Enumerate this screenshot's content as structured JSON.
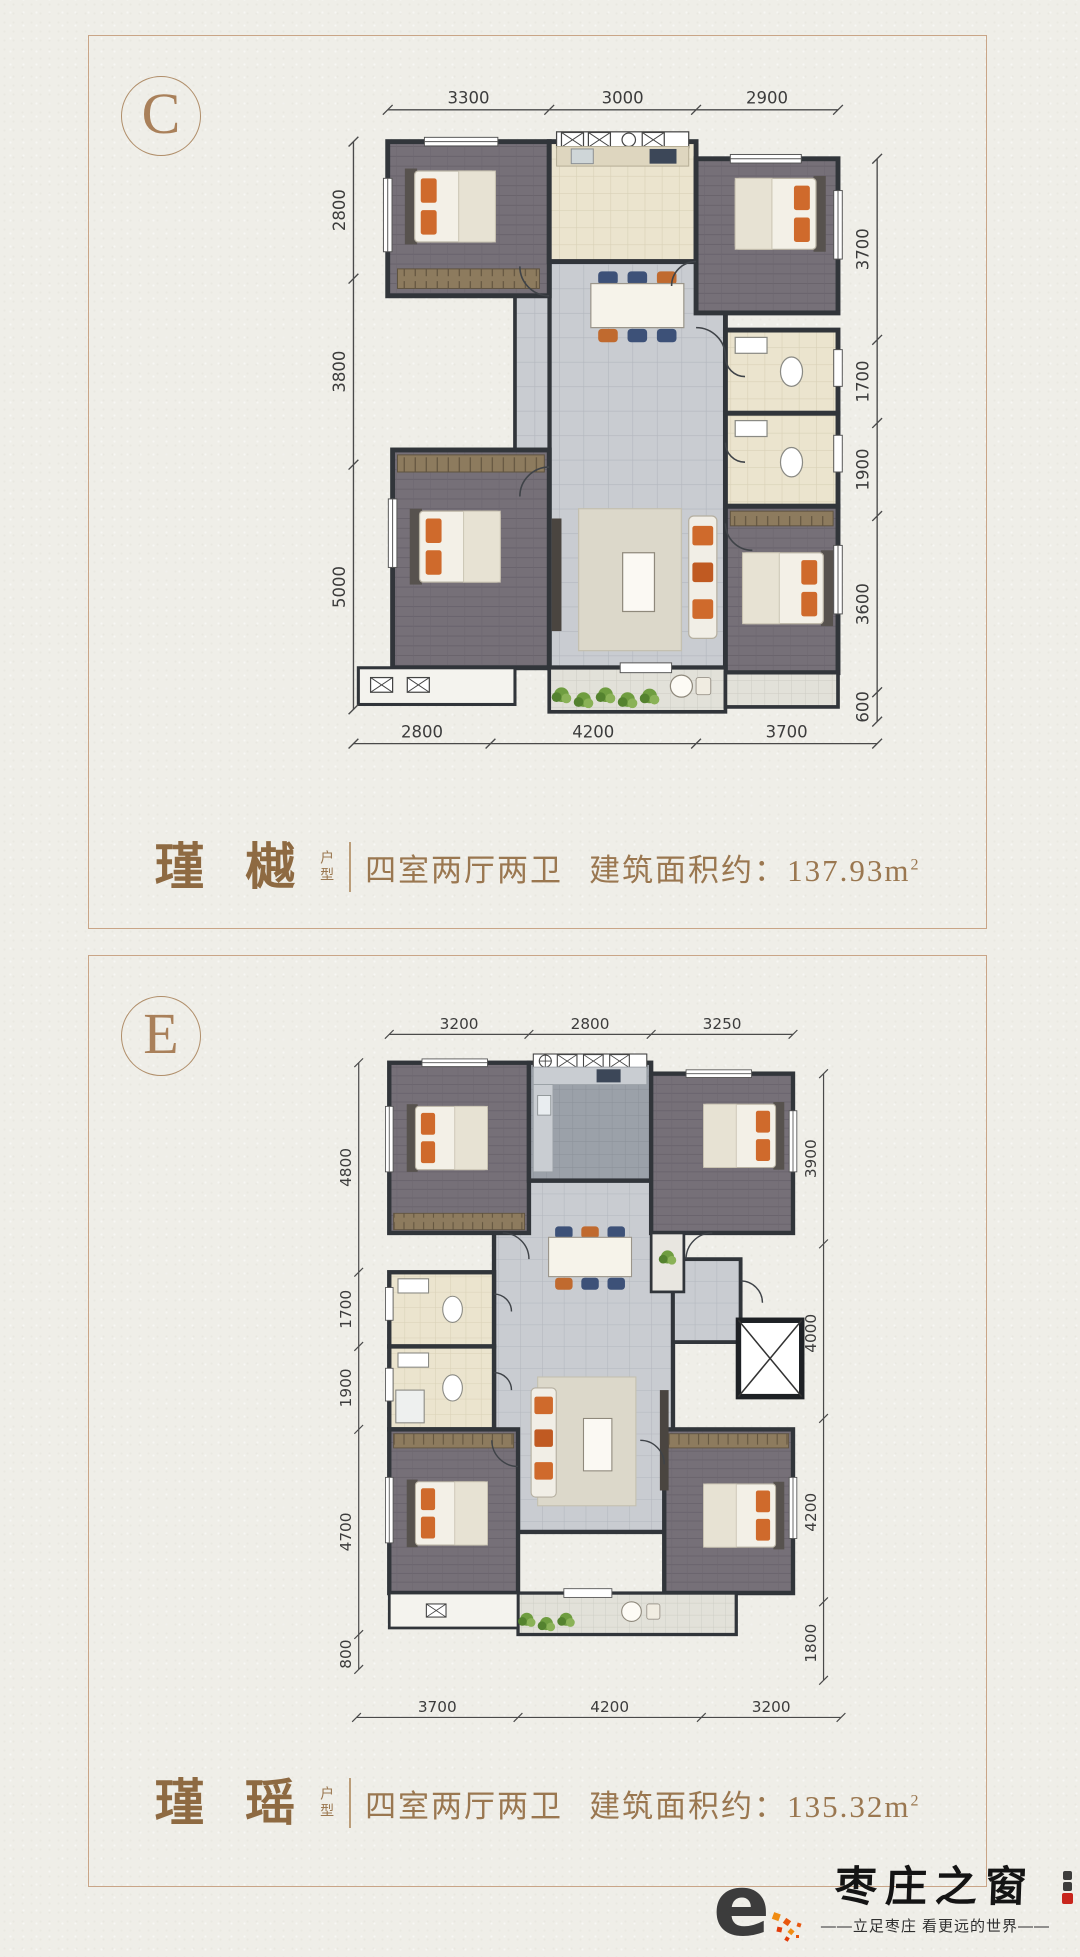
{
  "page": {
    "background": "#efeee8",
    "panel_border_color": "#c9a587",
    "accent_bronze": "#9a7750"
  },
  "plans": [
    {
      "label": "C",
      "name_calligraphy": "瑾 樾",
      "type_label": "户型",
      "spec": "四室两厅两卫",
      "area_label": "建筑面积约：",
      "area_value": "137.93m",
      "area_sup": "2",
      "dims": {
        "top": [
          "3300",
          "3000",
          "2900"
        ],
        "left": [
          "2800",
          "3800",
          "5000"
        ],
        "right": [
          "3700",
          "1700",
          "1900",
          "3600",
          "600"
        ],
        "bottom": [
          "2800",
          "4200",
          "3700"
        ]
      }
    },
    {
      "label": "E",
      "name_calligraphy": "瑾 瑶",
      "type_label": "户型",
      "spec": "四室两厅两卫",
      "area_label": "建筑面积约：",
      "area_value": "135.32m",
      "area_sup": "2",
      "dims": {
        "top": [
          "3200",
          "2800",
          "3250"
        ],
        "left": [
          "4800",
          "1700",
          "1900",
          "4700",
          "800"
        ],
        "right": [
          "3900",
          "4000",
          "4200",
          "1800"
        ],
        "bottom": [
          "3700",
          "4200",
          "3200"
        ]
      }
    }
  ],
  "logo": {
    "glyph": "e",
    "brand": "枣庄之窗",
    "tagline": "——立足枣庄  看更远的世界——",
    "gradient_top": "#f9a517",
    "gradient_bottom": "#e23c0a"
  }
}
